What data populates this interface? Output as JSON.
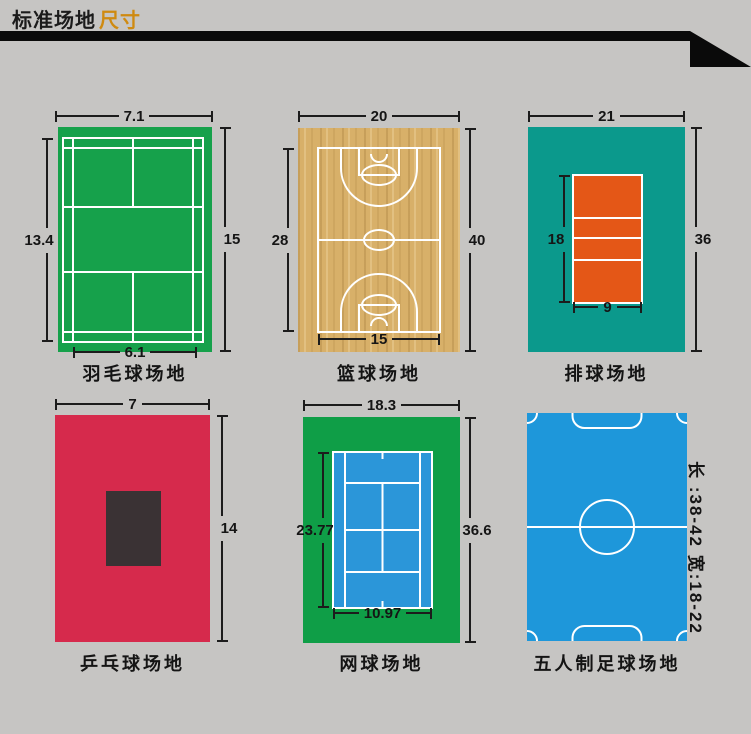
{
  "header": {
    "title_main": "标准场地",
    "title_accent": "尺寸"
  },
  "colors": {
    "page_bg": "#c6c5c3",
    "ribbon": "#0a0a0a",
    "title_text": "#1b1b1b",
    "title_accent": "#cf8a10",
    "dim_line": "#1c1c1c",
    "court_line": "#ffffff",
    "badminton_green": "#16a14b",
    "wood_base": "#d8b069",
    "volleyball_teal": "#0b998c",
    "volleyball_orange": "#e45717",
    "tabletennis_red": "#d62a4c",
    "table_dark": "#3a3234",
    "tennis_green": "#0f9e47",
    "tennis_blue": "#2b96d9",
    "football_blue": "#1e97da"
  },
  "courts": [
    {
      "label": "羽毛球场地",
      "dims": {
        "top": "7.1",
        "left": "13.4",
        "right": "15",
        "bottom": "6.1"
      }
    },
    {
      "label": "篮球场地",
      "dims": {
        "top": "20",
        "left": "28",
        "right": "40",
        "bottom": "15"
      }
    },
    {
      "label": "排球场地",
      "dims": {
        "top": "21",
        "left": "18",
        "right": "36",
        "bottom": "9"
      }
    },
    {
      "label": "乒乓球场地",
      "dims": {
        "top": "7",
        "right": "14"
      }
    },
    {
      "label": "网球场地",
      "dims": {
        "top": "18.3",
        "left": "23.77",
        "right": "36.6",
        "bottom": "10.97"
      }
    },
    {
      "label": "五人制足球场地",
      "side_note": "长 :38-42   宽:18-22"
    }
  ]
}
